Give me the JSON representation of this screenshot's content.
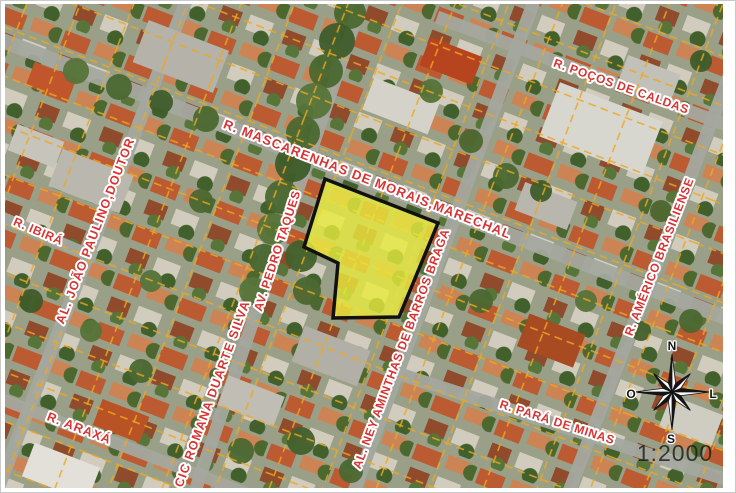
{
  "map": {
    "type": "aerial-cadastral-map",
    "scale_label": "1:2000",
    "street_labels": [
      {
        "id": "pocos-de-caldas",
        "text": "R. POÇOS DE CALDAS"
      },
      {
        "id": "mascarenhas",
        "text": "R. MASCARENHAS DE MORAIS,MARECHAL"
      },
      {
        "id": "joao-paulino",
        "text": "AL. JOÃO PAULINO,DOUTOR"
      },
      {
        "id": "ibira",
        "text": "R. IBIRÁ"
      },
      {
        "id": "pedro-taques",
        "text": "AV. PEDRO TAQUES"
      },
      {
        "id": "romana-duarte",
        "text": "CIC ROMANA DUARTE SILVA"
      },
      {
        "id": "ney-aminthas",
        "text": "AL. NEY AMINTHAS DE BARROS BRAGA"
      },
      {
        "id": "americo",
        "text": "R. AMÉRICO BRASILIENSE"
      },
      {
        "id": "para-de-minas",
        "text": "R. PARÁ DE MINAS"
      },
      {
        "id": "araxa",
        "text": "R. ARAXÁ"
      }
    ],
    "compass": {
      "north": "N",
      "south": "S",
      "west": "O",
      "east": "L"
    },
    "colors": {
      "label_red": "#d93434",
      "parcel_yellow": "#e8ec3e",
      "cadastral_orange": "#eda71f",
      "street_gray": "#a4a89f"
    }
  }
}
